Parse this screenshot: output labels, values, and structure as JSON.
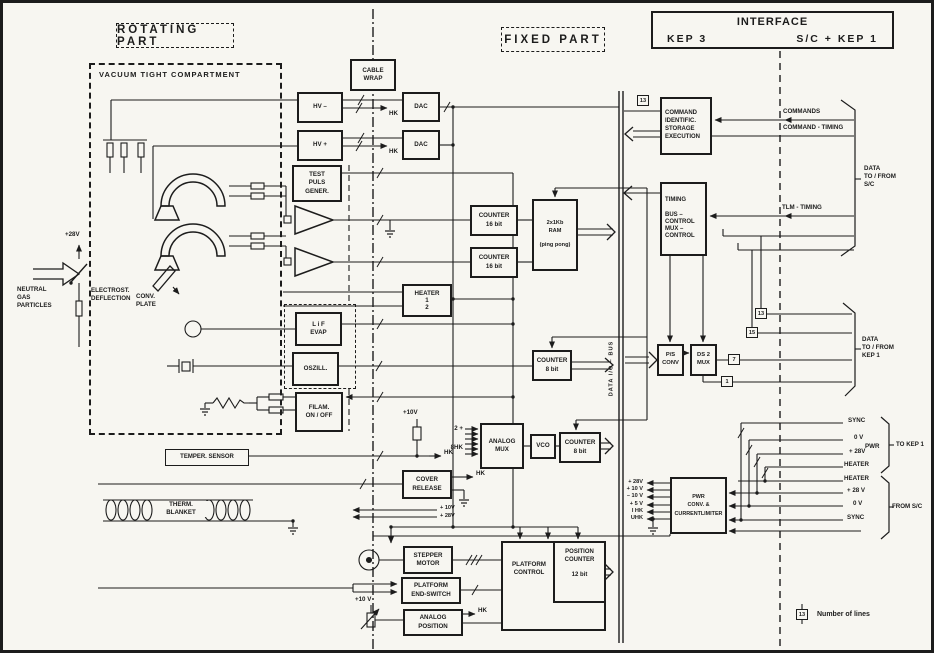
{
  "headers": {
    "rotating_part": "ROTATING  PART",
    "fixed_part": "FIXED   PART",
    "interface": "INTERFACE",
    "kep3": "KEP 3",
    "sc_kep1": "S/C + KEP 1",
    "vacuum_compartment": "VACUUM  TIGHT  COMPARTMENT"
  },
  "blocks": {
    "cable_wrap": "CABLE\nWRAP",
    "hv_minus": "HV –",
    "hv_plus": "HV +",
    "dac_top": "DAC",
    "dac_bottom": "DAC",
    "test_puls": "TEST\nPULS\nGENER.",
    "counter16_top": "COUNTER\n16 bit",
    "counter16_bottom": "COUNTER\n16 bit",
    "ram": "2x1Kb\nRAM\n\n(ping pong)",
    "heater": "HEATER\n1\n2",
    "lif_evap": "L i F\nEVAP",
    "oszill": "OSZILL.",
    "counter8_mid": "COUNTER\n8 bit",
    "filam": "FILAM.\nON / OFF",
    "temper_sensor": "TEMPER. SENSOR",
    "analog_mux": "ANALOG\nMUX",
    "vco": "VCO",
    "counter8_low": "COUNTER\n8 bit",
    "cover_release": "COVER\nRELEASE",
    "stepper_motor": "STEPPER\nMOTOR",
    "platform_end_switch": "PLATFORM\nEND-SWITCH",
    "analog_position": "ANALOG\nPOSITION",
    "platform_control": "PLATFORM\nCONTROL",
    "position_counter": "POSITION\nCOUNTER\n\n12  bit",
    "command_ident": "COMMAND\nIDENTIFIC.\nSTORAGE\nEXECUTION",
    "timing": "TIMING\n\nBUS –\nCONTROL\nMUX –\nCONTROL",
    "ps_conv": "P/S\nCONV",
    "ds2_mux": "DS 2\nMUX",
    "pwr_conv": "PWR\nCONV. &\nCURRENTLIMITER"
  },
  "labels": {
    "neutral_gas": "NEUTRAL\nGAS\nPARTICLES",
    "electrost": "ELECTROST.\nDEFLECTION",
    "conv_plate": "CONV.\nPLATE",
    "therm_blanket": "THERM.\nBLANKET",
    "v28_defl": "+28V",
    "hk_hv_minus": "HK",
    "hk_hv_plus": "HK",
    "hk_temper": "HK",
    "hk_cover": "HK",
    "hk_pos": "HK",
    "v10_mux": "+10V",
    "v10_line": "+ 10V",
    "v28_line": "+ 28V",
    "v10_pot": "+10 V",
    "mux_in_a": "2 +",
    "mux_in_b": "8HK",
    "bus": "DATA  I/O – BUS"
  },
  "iface": {
    "commands": "COMMANDS",
    "command_timing": "COMMAND - TIMING",
    "tlm_timing": "TLM - TIMING",
    "data_sc": "DATA\nTO / FROM\nS/C",
    "data_kep1": "DATA\nTO / FROM\nKEP 1",
    "sync_to": "SYNC",
    "ov_to": "0 V",
    "pwr_group": "PWR",
    "v28_to": "+ 28V",
    "heater_to": "HEATER",
    "to_kep1": "TO KEP 1",
    "heater_from": "HEATER",
    "v28_from": "+ 28 V",
    "ov_from": "0 V",
    "sync_from": "SYNC",
    "from_sc": "FROM  S/C"
  },
  "pwr_inputs": [
    "+ 28V",
    "+ 10 V",
    "– 10 V",
    "+  5 V",
    "I HK",
    "UHK"
  ],
  "line_numbers": {
    "cmd": "13",
    "d13": "13",
    "d15": "15",
    "d7": "7",
    "d1": "1",
    "legend_num": "13"
  },
  "legend": {
    "text": "Number  of  lines"
  }
}
